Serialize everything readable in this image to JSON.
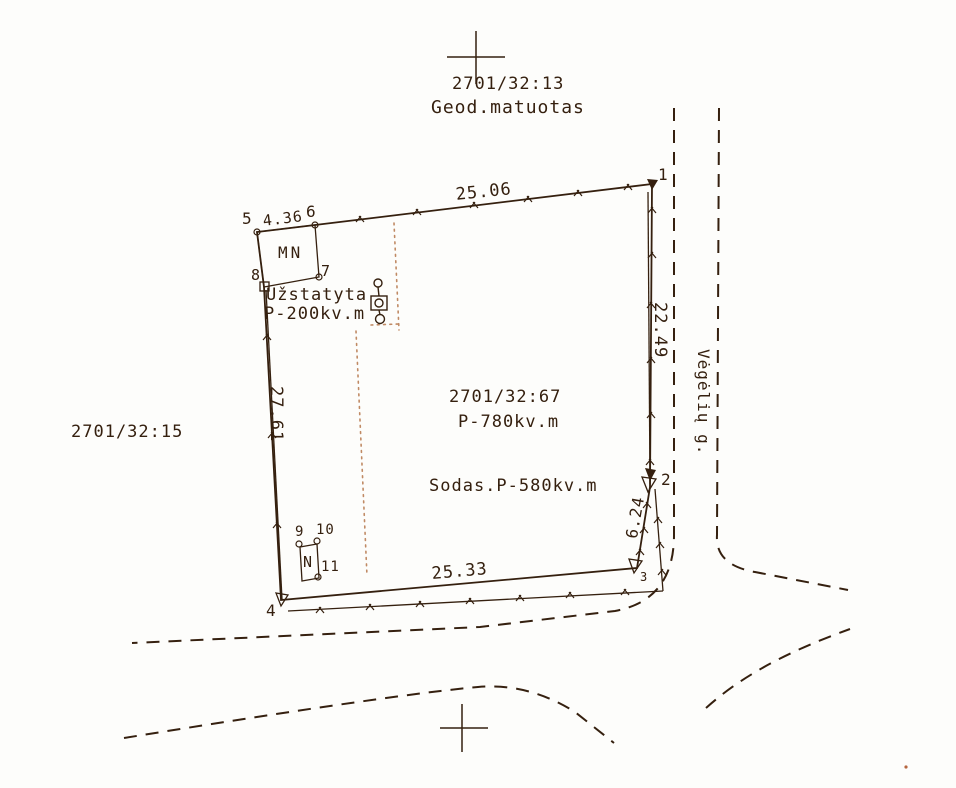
{
  "drawing": {
    "title_block": {
      "cadastral_no": "2701/32:13",
      "survey_note": "Geod.matuotas"
    },
    "adjacent_parcel": "2701/32:15",
    "street_name": "Vėgėlių g.",
    "parcel": {
      "cadastral_no": "2701/32:67",
      "total_area": "P-780kv.m",
      "garden_area": "Sodas.P-580kv.m",
      "built_label": "Užstatyta",
      "built_area": "P-200kv.m"
    },
    "buildings": {
      "mn_label": "MN",
      "n_label": "N"
    },
    "dimensions": {
      "north_side": "25.06",
      "east_side": "22.49",
      "west_side": "27.61",
      "south_side": "25.33",
      "southeast_side": "6.24",
      "northwest_side": "4.36"
    },
    "points": {
      "p1": "1",
      "p2": "2",
      "p3": "3",
      "p4": "4",
      "p5": "5",
      "p6": "6",
      "p7": "7",
      "p8": "8",
      "p9": "9",
      "p10": "10",
      "p11": "11"
    }
  },
  "colors": {
    "ink": "#35200f",
    "paper": "#fdfdfb",
    "dotted_line": "#c08a64"
  }
}
